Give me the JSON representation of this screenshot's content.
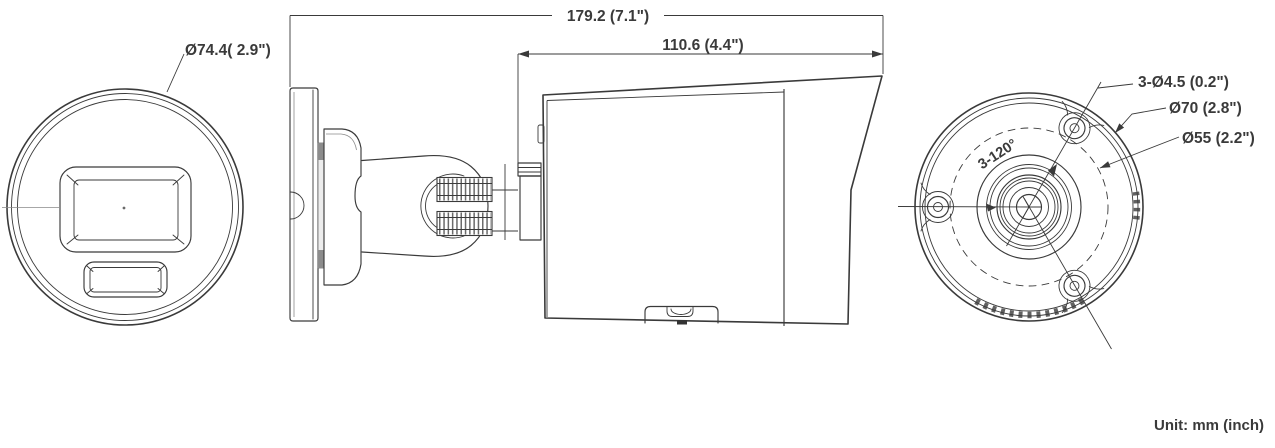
{
  "drawing": {
    "background": "#ffffff",
    "line_color": "#3a3a3a",
    "unit_note": "Unit: mm (inch)",
    "front_view": {
      "diameter_label": "Ø74.4( 2.9\")"
    },
    "side_view": {
      "overall_length_label": "179.2 (7.1\")",
      "body_length_label": "110.6 (4.4\")"
    },
    "rear_view": {
      "mount_holes_label": "3-Ø4.5 (0.2\")",
      "bolt_circle_label": "Ø70 (2.8\")",
      "inner_circle_label": "Ø55 (2.2\")",
      "hole_angle_label": "3-120°"
    }
  }
}
